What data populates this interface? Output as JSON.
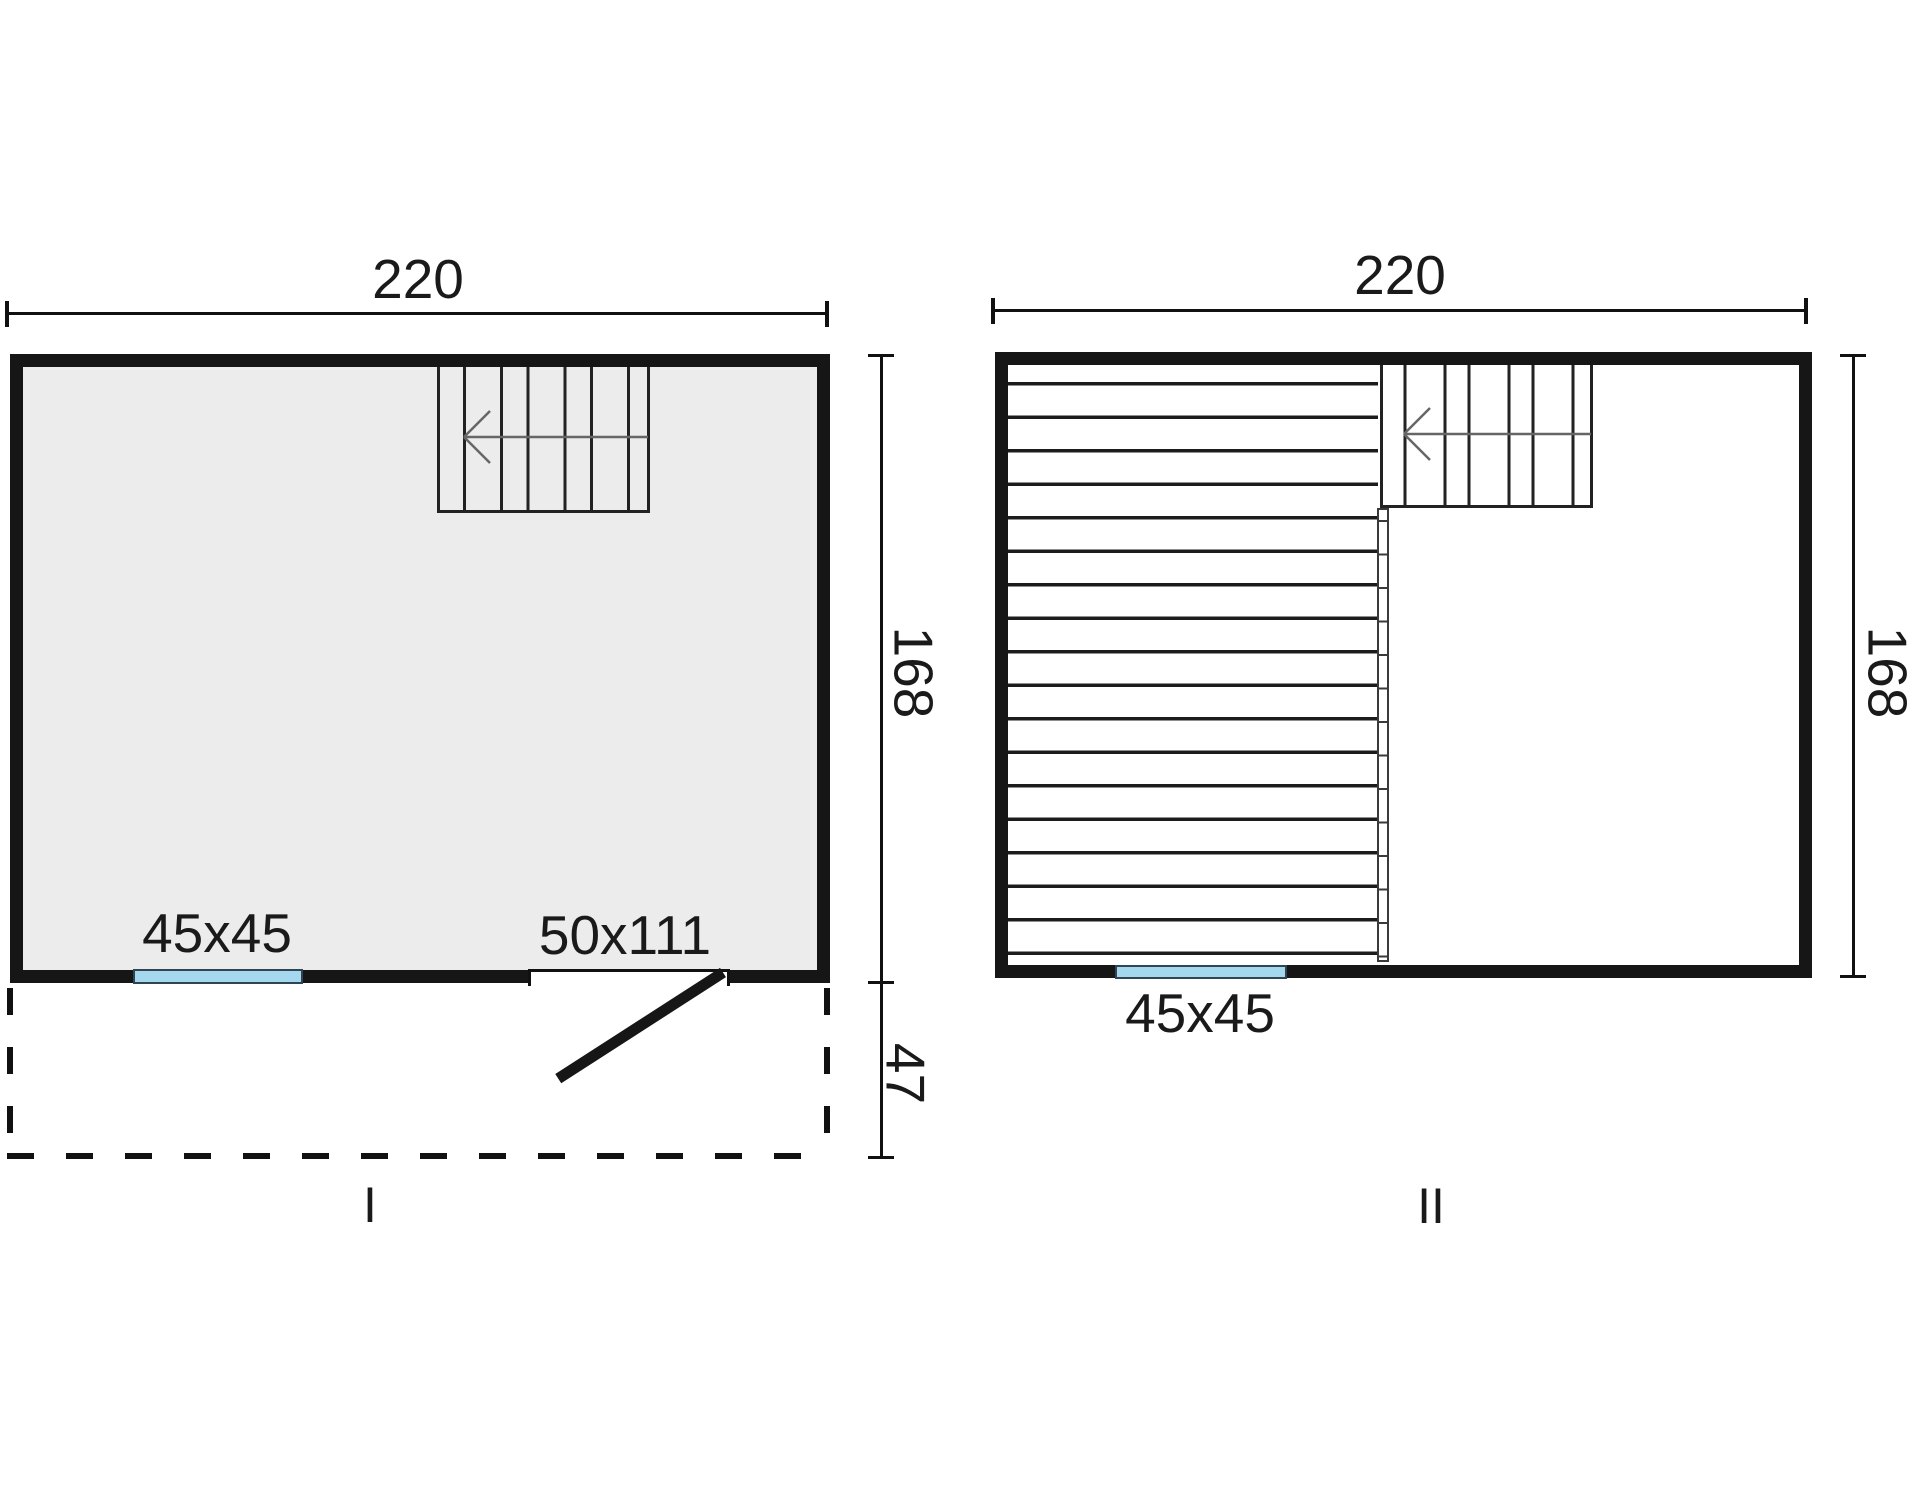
{
  "drawing_title": "two-storey cabin floor plans",
  "colors": {
    "wall": "#161616",
    "room_fill": "#ececec",
    "window_fill": "#a5d8ee",
    "window_border": "#2f4455",
    "drawing_line": "#111111",
    "stair_arrow": "#666666"
  },
  "plan_1": {
    "name_label": "I",
    "top_dimension": "220",
    "right_dimension": "168",
    "porch_dimension": "47",
    "window_label": "45x45",
    "door_label": "50x111"
  },
  "plan_2": {
    "name_label": "II",
    "top_dimension": "220",
    "right_dimension": "168",
    "window_label": "45x45"
  }
}
